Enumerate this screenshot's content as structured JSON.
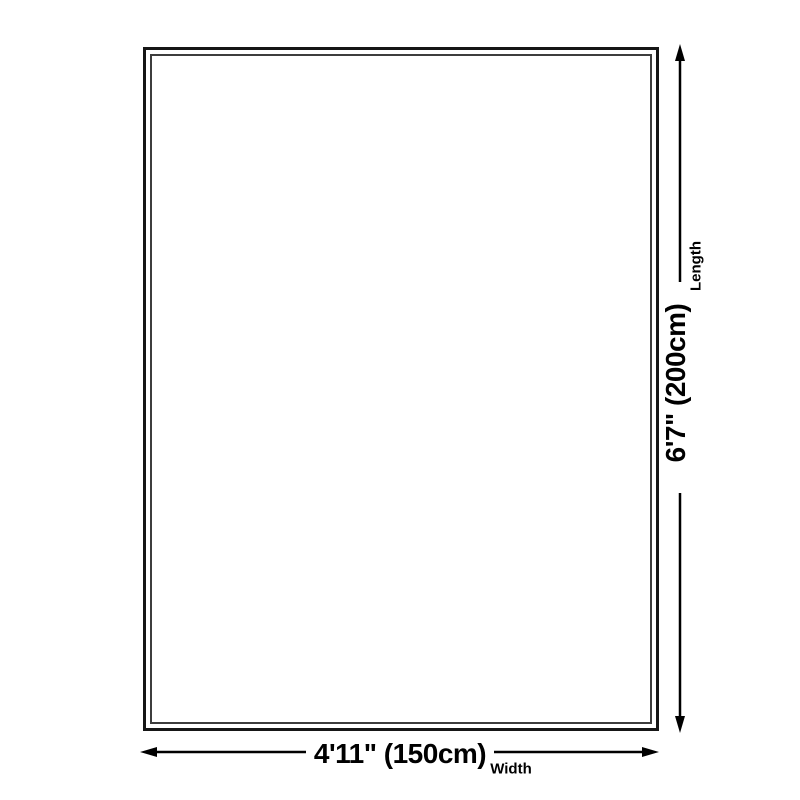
{
  "page": {
    "background_color": "#ffffff"
  },
  "diagram": {
    "type": "product-dimension-diagram",
    "line_color": "#000000",
    "frame_outer_border_color": "#161616",
    "frame_inner_border_color": "#3d3d3d",
    "length": {
      "value": "6'7\" (200cm)",
      "label": "Length"
    },
    "width": {
      "value": "4'11\" (150cm)",
      "label": "Width"
    }
  }
}
